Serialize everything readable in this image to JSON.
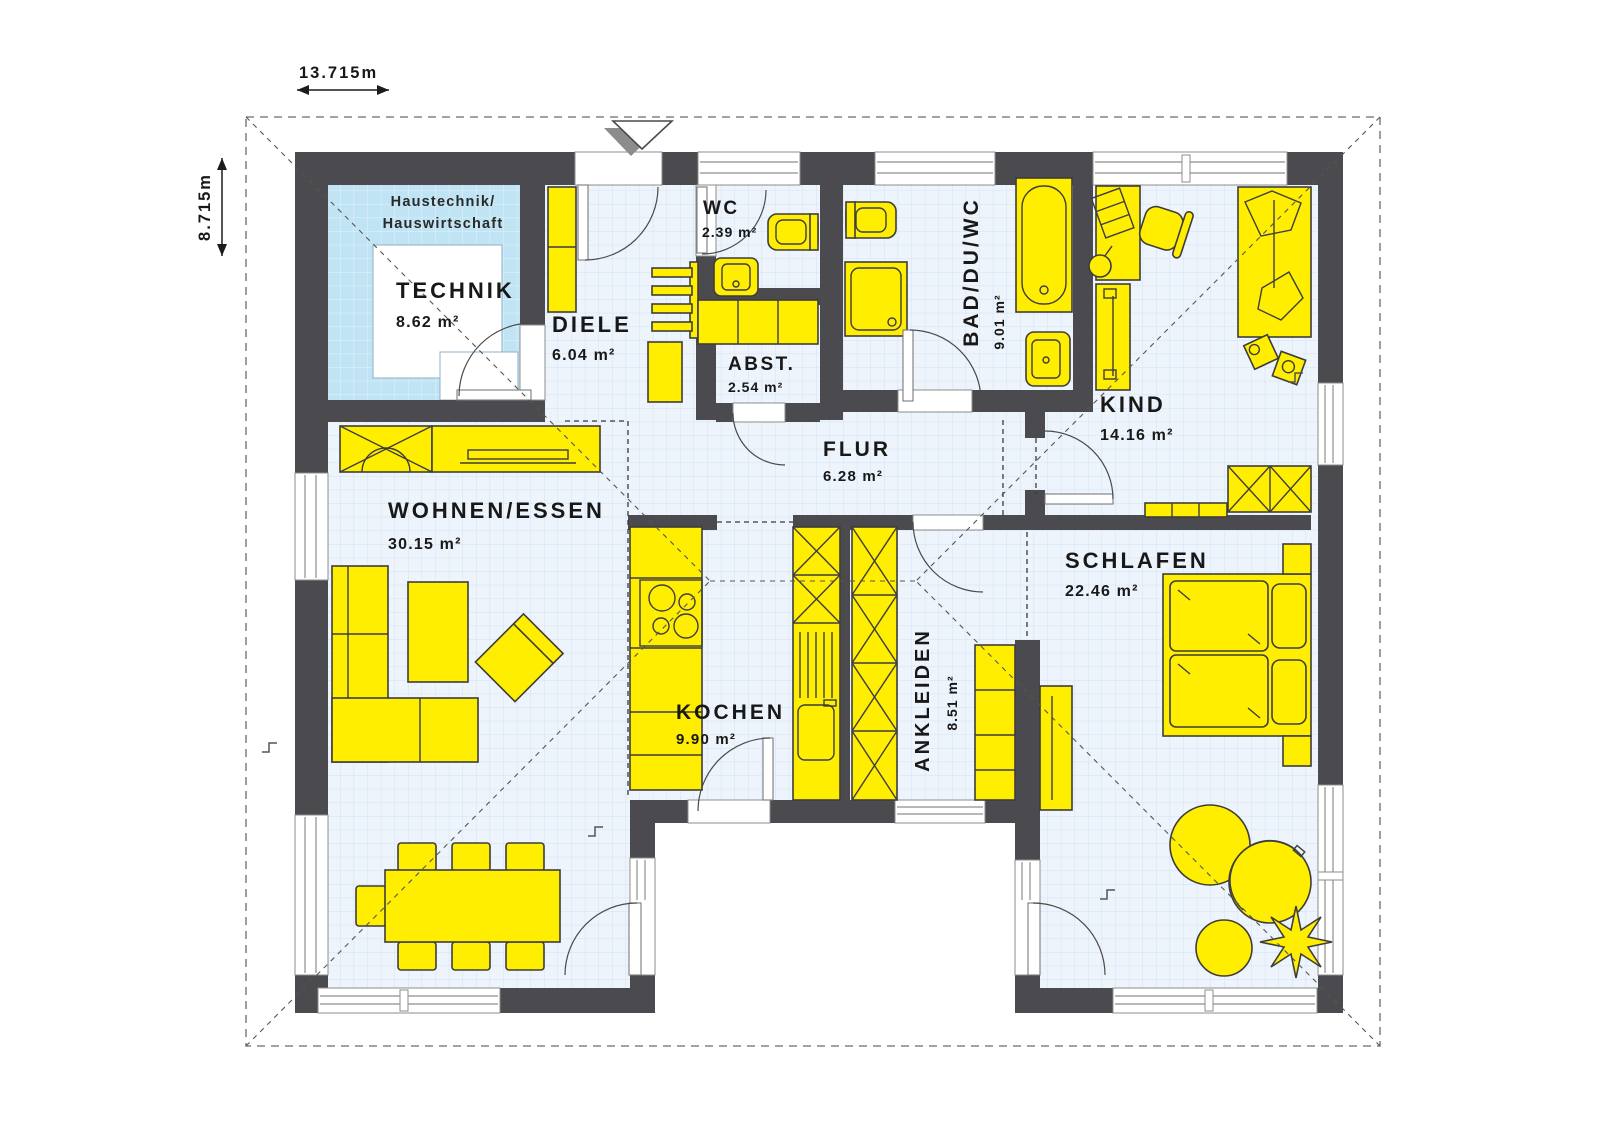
{
  "plan_title": "bungalow-floor-plan",
  "dimensions": {
    "width_label": "13.715m",
    "height_label": "8.715m"
  },
  "technik_note": {
    "line1": "Haustechnik/",
    "line2": "Hauswirtschaft"
  },
  "rooms": {
    "technik": {
      "name": "TECHNIK",
      "area": "8.62 m²"
    },
    "diele": {
      "name": "DIELE",
      "area": "6.04 m²"
    },
    "wc": {
      "name": "WC",
      "area": "2.39 m²"
    },
    "abst": {
      "name": "ABST.",
      "area": "2.54 m²"
    },
    "bad": {
      "name": "BAD/DU/WC",
      "area": "9.01 m²"
    },
    "kind": {
      "name": "KIND",
      "area": "14.16 m²"
    },
    "flur": {
      "name": "FLUR",
      "area": "6.28 m²"
    },
    "wohnen": {
      "name": "WOHNEN/ESSEN",
      "area": "30.15 m²"
    },
    "kochen": {
      "name": "KOCHEN",
      "area": "9.90 m²"
    },
    "ankleiden": {
      "name": "ANKLEIDEN",
      "area": "8.51 m²"
    },
    "schlafen": {
      "name": "SCHLAFEN",
      "area": "22.46 m²"
    }
  },
  "colors": {
    "wall": "#4b4b4f",
    "furniture_yellow": "#ffee00",
    "technik_blue": "#c0e4f4",
    "floor_tint": "#eef4fb",
    "grid_line": "#d3e2f4"
  }
}
